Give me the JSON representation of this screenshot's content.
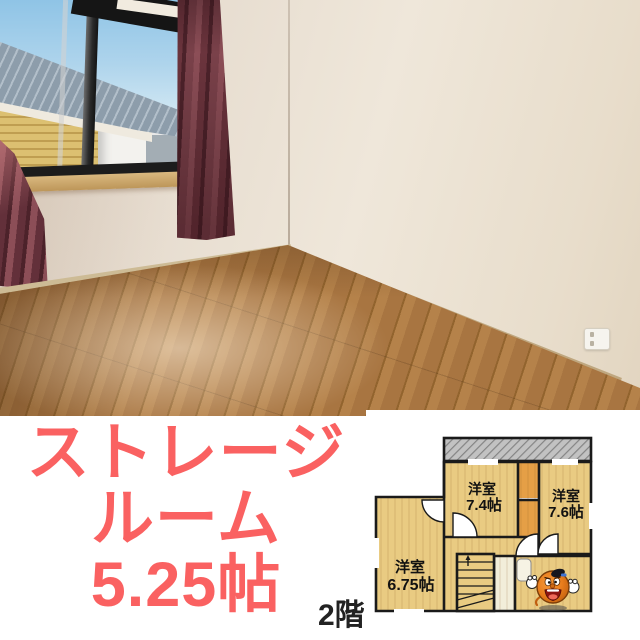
{
  "caption": {
    "line1": "ストレージ",
    "line2": "ルーム",
    "line3": "5.25帖",
    "color": "#fa6161"
  },
  "floorplan": {
    "floor_label": "2階",
    "rooms": [
      {
        "type": "洋室",
        "size": "7.4帖"
      },
      {
        "type": "洋室",
        "size": "7.6帖"
      },
      {
        "type": "洋室",
        "size": "6.75帖"
      }
    ],
    "mascot_icon": "orange-character-mascot",
    "room_fill": "#e9cb82",
    "closet_fill": "#e59f46",
    "wall_color": "#1a1a1a"
  },
  "photo": {
    "wall_color": "#e9e0d4",
    "curtain_color": "#6b343d",
    "floor_color": "#a87541",
    "sky_color": "#a9d0ea"
  }
}
